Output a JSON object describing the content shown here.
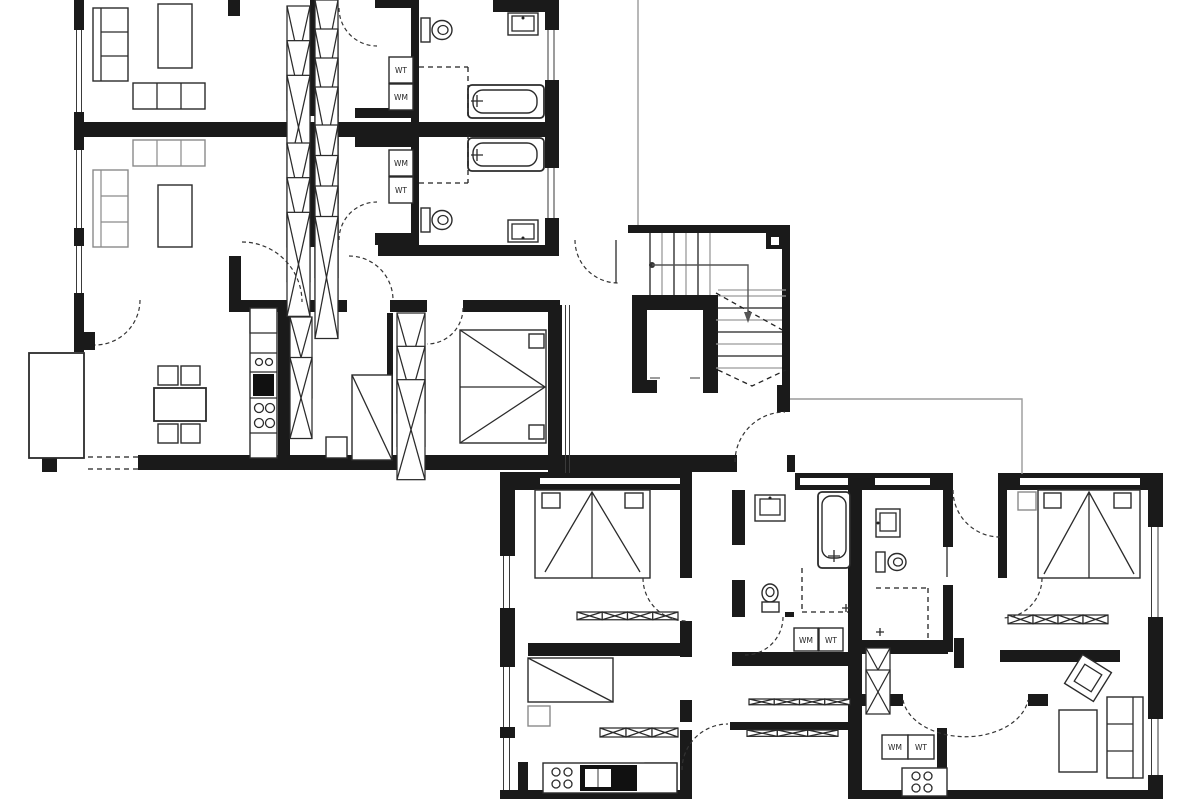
{
  "meta": {
    "kind": "architectural floor plan",
    "style": "black and white construction drawing"
  },
  "colors": {
    "wall": "#1a1a1a",
    "line": "#2b2b2b",
    "gray": "#9a9a9a",
    "background": "#ffffff"
  },
  "labels": [
    {
      "id": "unitA-top-dryer",
      "text": "WT"
    },
    {
      "id": "unitA-top-washer",
      "text": "WM"
    },
    {
      "id": "unitA-low-washer",
      "text": "WM"
    },
    {
      "id": "unitA-low-dryer",
      "text": "WT"
    },
    {
      "id": "unitC-washer",
      "text": "WM"
    },
    {
      "id": "unitC-dryer",
      "text": "WT"
    },
    {
      "id": "unitD-washer",
      "text": "WM"
    },
    {
      "id": "unitD-dryer",
      "text": "WT"
    }
  ],
  "symbols": [
    "sofa-icon",
    "coffee-table-icon",
    "sideboard-icon",
    "wardrobe-x-icon",
    "toilet-icon",
    "sink-icon",
    "bathtub-icon",
    "shower-icon",
    "dining-table-icon",
    "chair-icon",
    "stove-icon",
    "fridge-icon",
    "single-bed-icon",
    "double-bed-icon",
    "stairs-icon",
    "elevator-icon",
    "balcony-icon",
    "door-swing-icon"
  ]
}
